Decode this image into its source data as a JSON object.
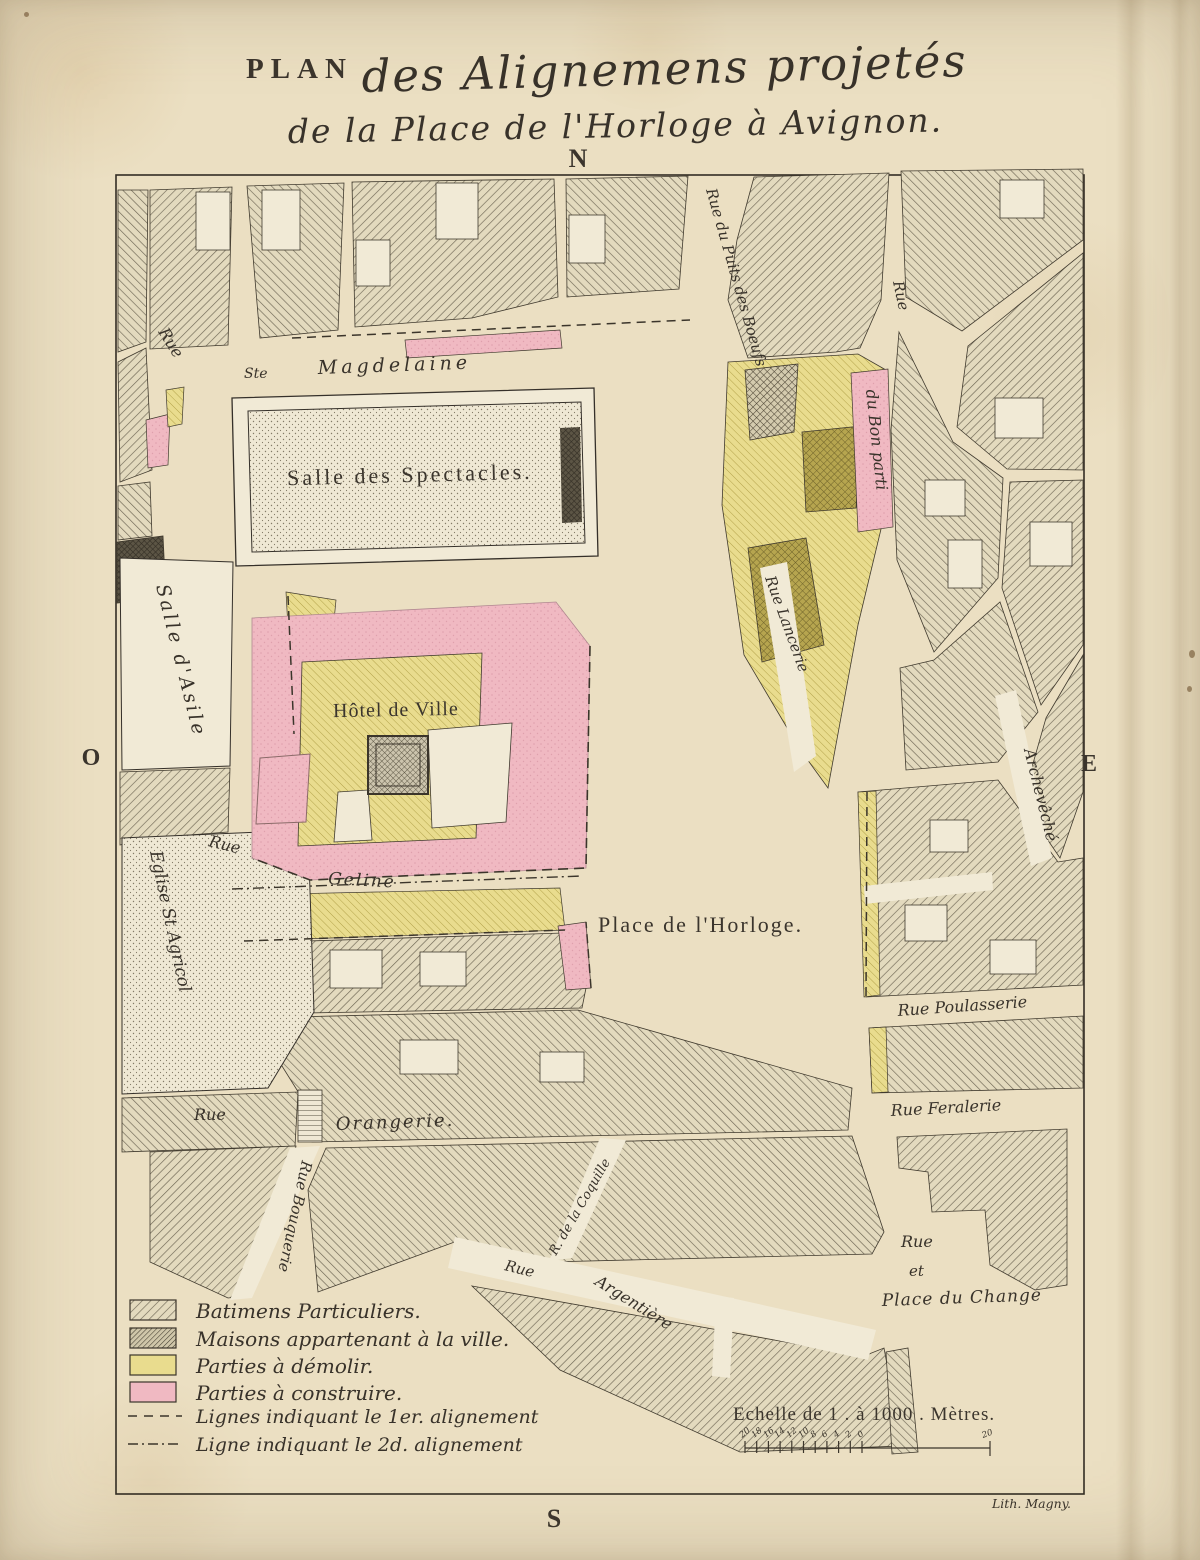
{
  "title": {
    "plan_word": "PLAN",
    "line1": "des Alignemens projetés",
    "line2": "de la Place de l'Horloge à Avignon."
  },
  "compass": {
    "north": "N",
    "south": "S",
    "west": "O",
    "east": "E"
  },
  "labels": {
    "rue_top_left": "Rue",
    "ste": "Ste",
    "magdelaine": "Magdelaine",
    "salle_des_spectacles": "Salle des Spectacles.",
    "rue_du_puits_des_boeufs": "Rue du Puits des Boeufs",
    "rue_bon": "Rue",
    "du_bon_parti": "du Bon parti",
    "rue_lancerie": "Rue Lancerie",
    "salle_d_asile": "Salle d'Asile",
    "hotel_de_ville": "Hôtel de Ville",
    "rue_geline": "Rue",
    "geline": "Geline",
    "eglise_st_agricol": "Eglise St Agricol",
    "place_de_l_horloge": "Place de l'Horloge.",
    "archeveche": "Archevêché",
    "rue_poulasserie": "Rue Poulasserie",
    "rue_feralerie": "Rue Feralerie",
    "rue_change": "Rue",
    "et_change": "et",
    "place_du_change": "Place du Change",
    "rue_orangerie": "Rue",
    "orangerie": "Orangerie.",
    "rue_bouquerie": "Rue Bouquerie",
    "rue_argentiere": "Rue",
    "argentiere": "Argentière",
    "r_de_la_coquille": "R. de la Coquille"
  },
  "legend": {
    "items": [
      {
        "swatch": "hatch-light",
        "label": "Batimens Particuliers."
      },
      {
        "swatch": "hatch-dark",
        "label": "Maisons appartenant à la ville."
      },
      {
        "swatch": "yellow",
        "label": "Parties à démolir."
      },
      {
        "swatch": "pink",
        "label": "Parties à construire."
      },
      {
        "swatch": "dashed",
        "label": "Lignes indiquant le 1er. alignement"
      },
      {
        "swatch": "dashdot",
        "label": "Ligne indiquant le 2d. alignement"
      }
    ]
  },
  "scale": {
    "caption": "Echelle de 1 . à 1000 . Mètres.",
    "tick_labels": [
      "20",
      "18",
      "16",
      "14",
      "12",
      "10",
      "8",
      "6",
      "4",
      "2",
      "0"
    ],
    "far_label": "20"
  },
  "credit": "Lith. Magny.",
  "colors": {
    "paper": "#ebdfc2",
    "street": "#f1ead6",
    "ink": "#3b352d",
    "pink": "#f0b9c2",
    "yellow": "#e9dc8e",
    "olive": "#b6a54f",
    "hatch_gray": "#6f6755",
    "dark_hatch": "#4e4636"
  }
}
